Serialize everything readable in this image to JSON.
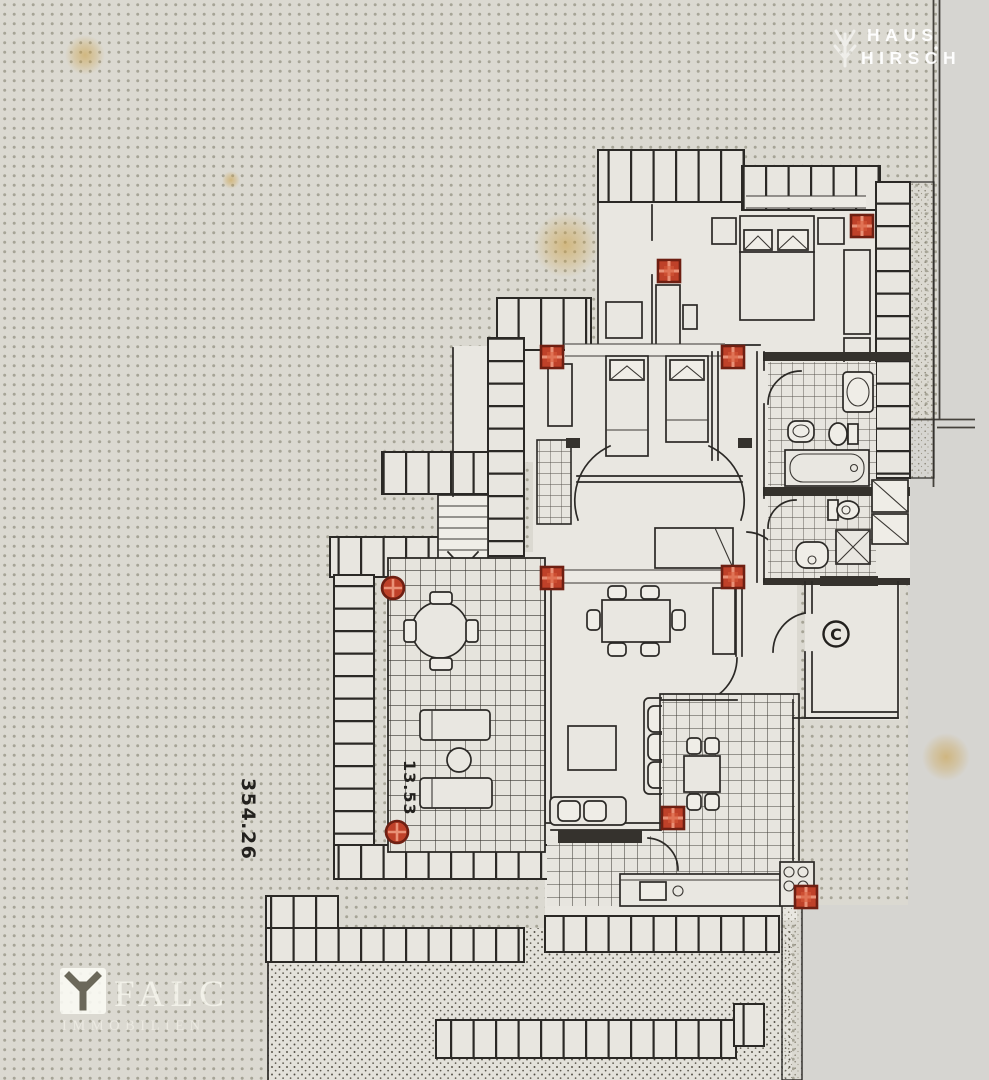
{
  "watermarks": {
    "haus_hirsch": {
      "line1": "HAUS",
      "line2": "HIRSCH",
      "icon": "antler-icon"
    },
    "falc": {
      "name": "FALC",
      "subtitle": "IMMOBILIEN",
      "icon": "falc-emblem-icon"
    }
  },
  "floor_plan": {
    "labels": {
      "area_dimension": "354.26",
      "terrace_dimension": "13.53",
      "entrance": "C"
    },
    "markers": {
      "squares": [
        [
          862,
          226
        ],
        [
          669,
          271
        ],
        [
          552,
          357
        ],
        [
          733,
          357
        ],
        [
          552,
          578
        ],
        [
          733,
          577
        ],
        [
          673,
          818
        ],
        [
          806,
          897
        ]
      ],
      "circles": [
        [
          393,
          588
        ],
        [
          397,
          832
        ]
      ]
    },
    "stains": [
      [
        85,
        55,
        20
      ],
      [
        231,
        180,
        9
      ],
      [
        566,
        245,
        33
      ],
      [
        946,
        757,
        24
      ]
    ],
    "colors": {
      "paper": "#dbd9d1",
      "paper_margin": "#d6d5d1",
      "paper_dot": "#a6a496",
      "ink": "#2b2926",
      "room_fill": "#e9e7e1",
      "marker_fill": "#bf4129",
      "marker_border": "#6e1f12",
      "marker_cross": "#ee9a80",
      "stain": "#c99c3e"
    }
  }
}
